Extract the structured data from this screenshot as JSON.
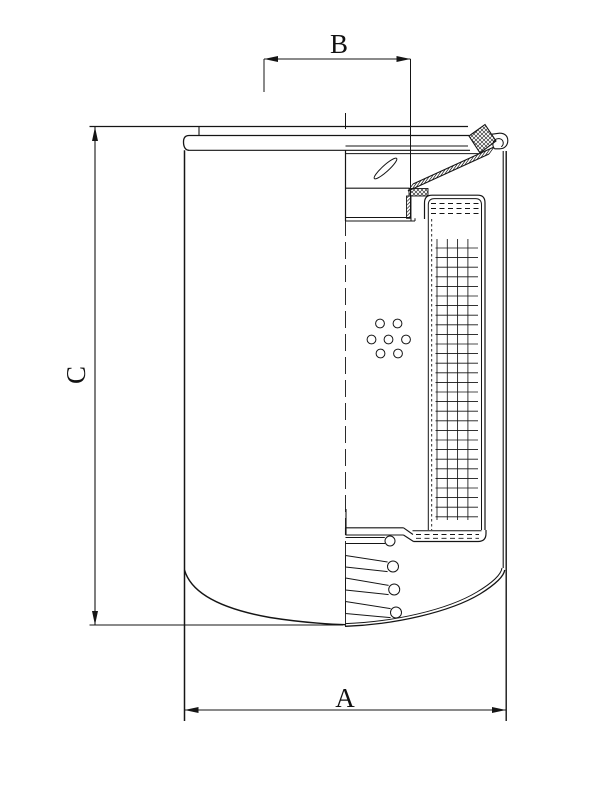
{
  "drawing": {
    "labels": {
      "a": "A",
      "b": "B",
      "c": "C"
    },
    "colors": {
      "ink": "#151515",
      "background": "#ffffff"
    }
  }
}
